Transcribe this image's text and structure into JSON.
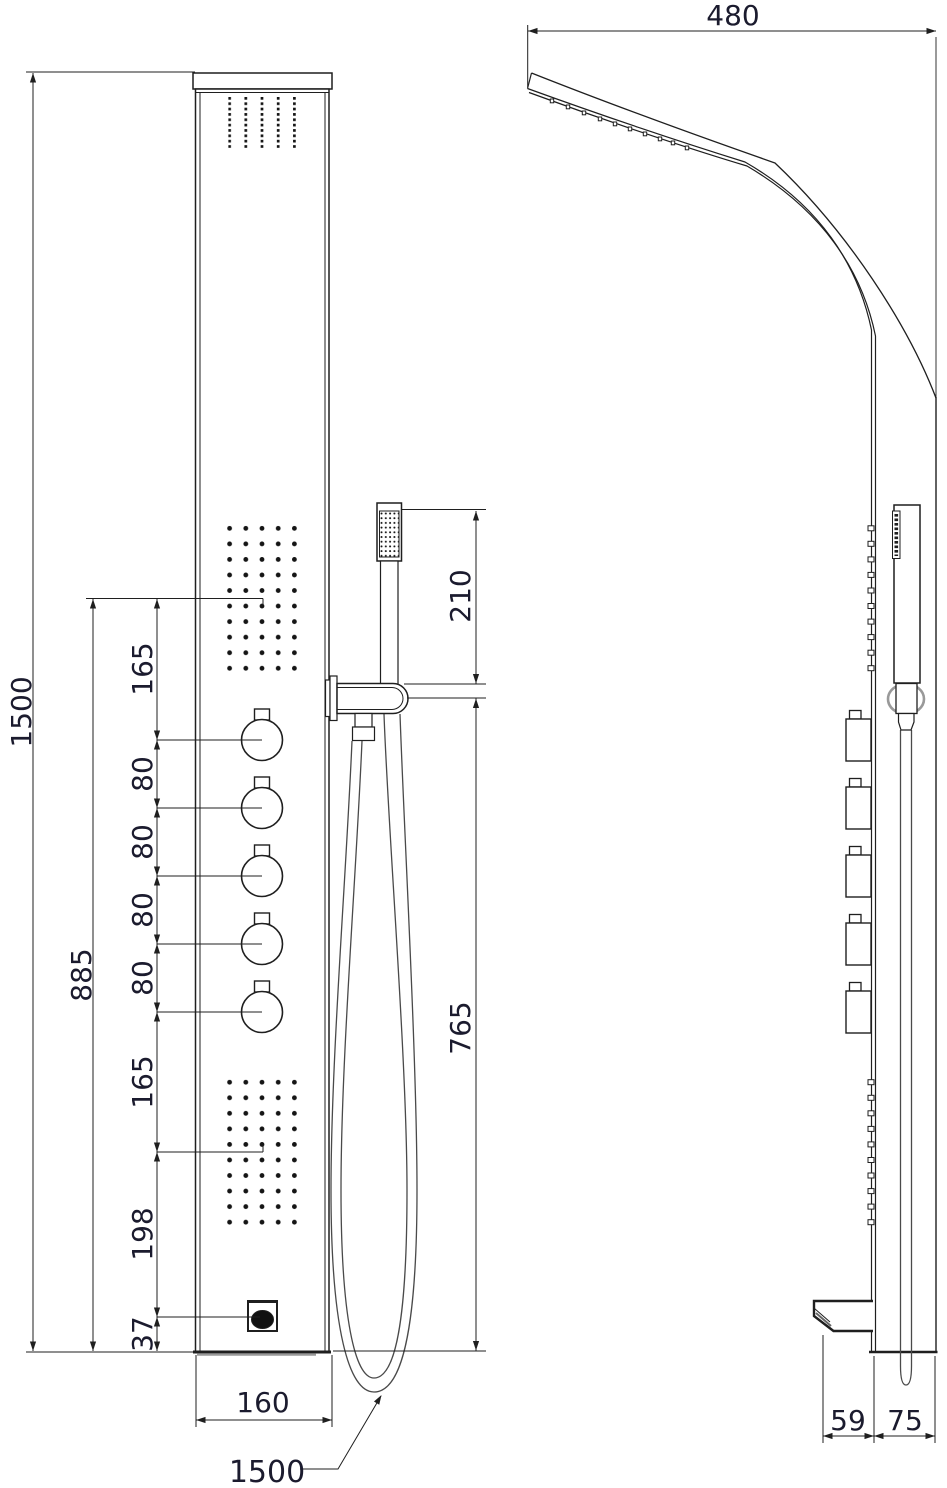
{
  "drawing_title": "shower-panel-technical-drawing",
  "front_view": {
    "overall_height": "1500",
    "controls_span": "885",
    "spacing_labels": [
      "165",
      "80",
      "80",
      "80",
      "80",
      "165",
      "198",
      "37"
    ],
    "handset_length": "210",
    "hose_drop": "765",
    "panel_width": "160",
    "hose_length": "1500"
  },
  "side_view": {
    "head_depth": "480",
    "spout_depth": "59",
    "panel_depth": "75"
  },
  "colors": {
    "line": "#1f1f1f",
    "text": "#1b1b2e",
    "hose": "#4a4a4a",
    "shade": "#999999"
  }
}
